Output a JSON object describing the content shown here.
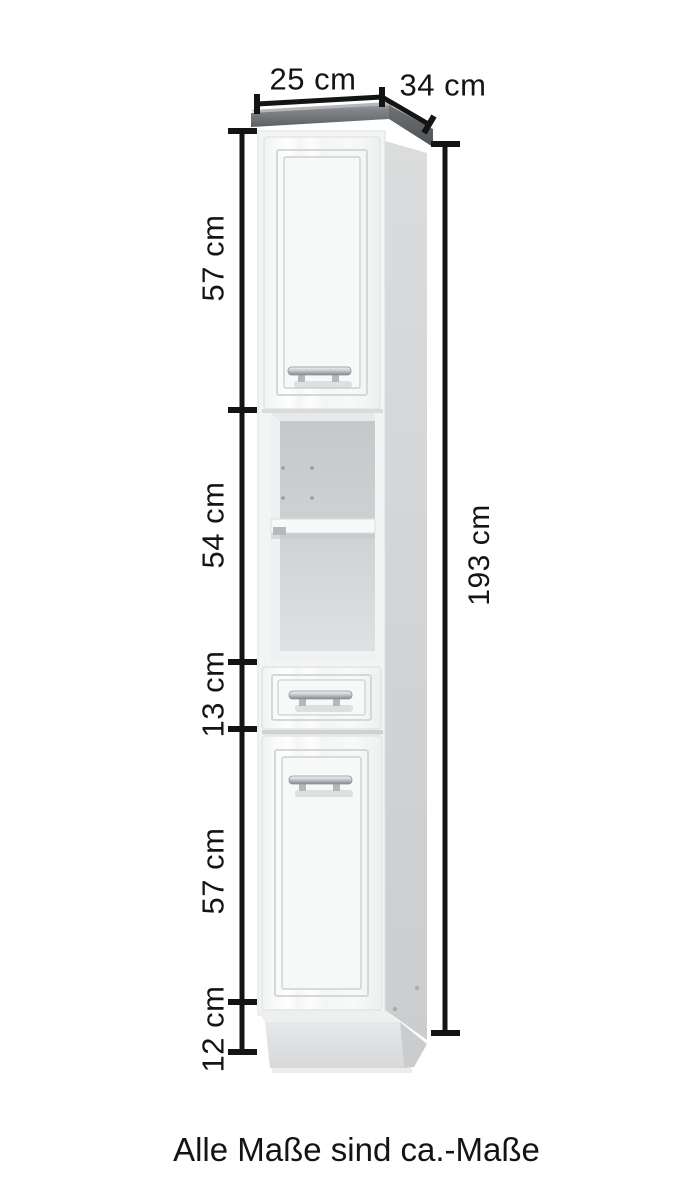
{
  "measurements": {
    "top_width": {
      "label": "25 cm",
      "value_cm": 25
    },
    "top_depth": {
      "label": "34 cm",
      "value_cm": 34
    },
    "total_height": {
      "label": "193 cm",
      "value_cm": 193
    },
    "sections": [
      {
        "name": "upper-door-height",
        "label": "57 cm",
        "value_cm": 57
      },
      {
        "name": "open-compartment-height",
        "label": "54 cm",
        "value_cm": 54
      },
      {
        "name": "drawer-height",
        "label": "13 cm",
        "value_cm": 13
      },
      {
        "name": "lower-door-height",
        "label": "57 cm",
        "value_cm": 57
      },
      {
        "name": "plinth-height",
        "label": "12 cm",
        "value_cm": 12
      }
    ]
  },
  "caption": {
    "text": "Alle Maße sind ca.-Maße"
  },
  "colors": {
    "background": "#ffffff",
    "dimension_lines": "#141414",
    "text": "#141414",
    "cabinet_top_slab": "#6d7174",
    "cabinet_front": "#fafafa",
    "cabinet_side": "#d5d7d8",
    "niche_interior": "#ced1d3",
    "plinth": "#dfe1e2",
    "handle_chrome": "#b9bec2"
  }
}
